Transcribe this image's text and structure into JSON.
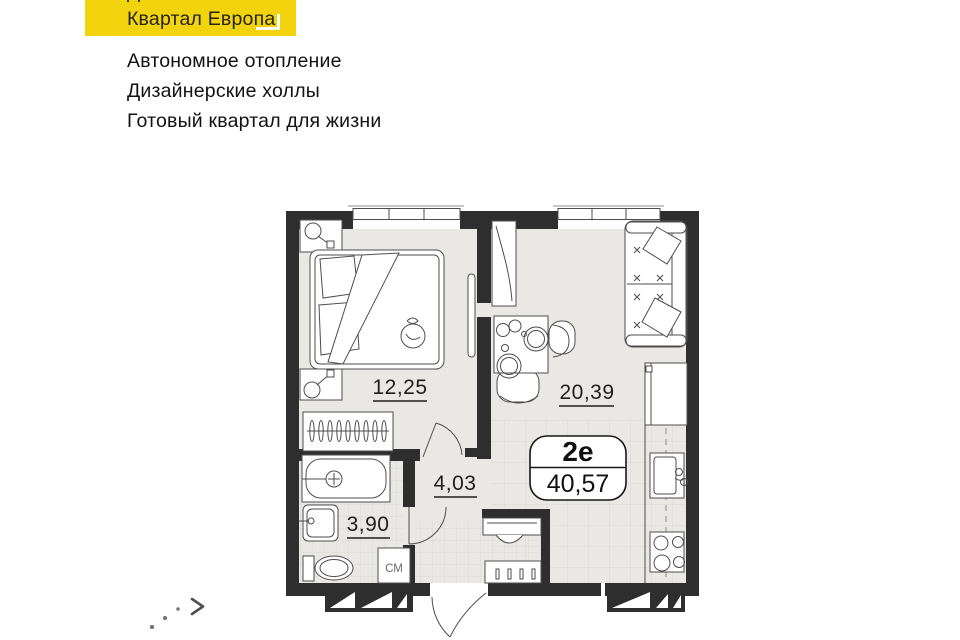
{
  "header": {
    "badge": {
      "line1": "Дом № 40",
      "line2": "Квартал Европа",
      "bg_color": "#F1D40E"
    },
    "features": [
      "Автономное отопление",
      "Дизайнерские холлы",
      "Готовый квартал для жизни"
    ]
  },
  "plan": {
    "apartment": {
      "type": "2е",
      "total_area": "40,57"
    },
    "rooms": [
      {
        "name": "bedroom",
        "area": "12,25"
      },
      {
        "name": "living-kitchen",
        "area": "20,39"
      },
      {
        "name": "hallway",
        "area": "4,03"
      },
      {
        "name": "bathroom",
        "area": "3,90"
      }
    ],
    "washer_label": "СМ"
  },
  "carousel": {
    "next_icon": "chevron-right"
  },
  "colors": {
    "accent_yellow": "#F1D40E",
    "wall": "#2E2E2E",
    "floor": "#E9E8E5"
  }
}
